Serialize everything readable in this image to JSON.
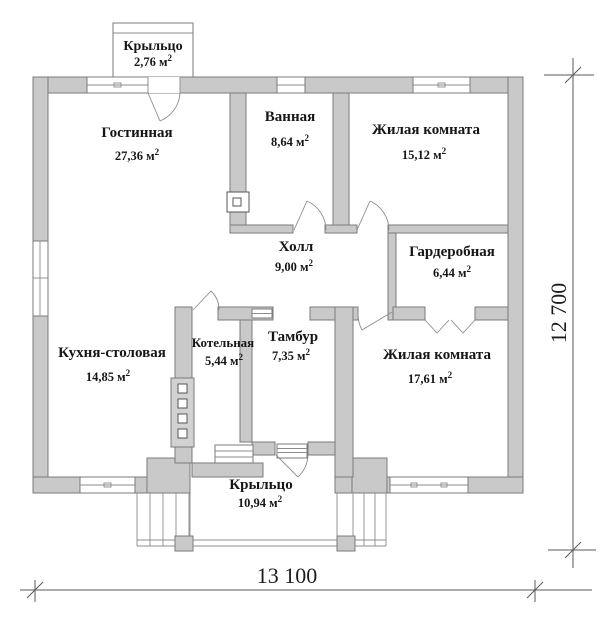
{
  "plan": {
    "type": "floor-plan",
    "rooms": [
      {
        "name": "Крыльцо",
        "area": "2,76 м",
        "sup": "2"
      },
      {
        "name": "Гостинная",
        "area": "27,36 м",
        "sup": "2"
      },
      {
        "name": "Ванная",
        "area": "8,64 м",
        "sup": "2"
      },
      {
        "name": "Жилая комната",
        "area": "15,12 м",
        "sup": "2"
      },
      {
        "name": "Холл",
        "area": "9,00 м",
        "sup": "2"
      },
      {
        "name": "Гардеробная",
        "area": "6,44 м",
        "sup": "2"
      },
      {
        "name": "Кухня-столовая",
        "area": "14,85 м",
        "sup": "2"
      },
      {
        "name": "Котельная",
        "area": "5,44 м",
        "sup": "2"
      },
      {
        "name": "Тамбур",
        "area": "7,35 м",
        "sup": "2"
      },
      {
        "name": "Жилая комната",
        "area": "17,61 м",
        "sup": "2"
      },
      {
        "name": "Крыльцо",
        "area": "10,94 м",
        "sup": "2"
      }
    ],
    "dimensions": {
      "width": "13 100",
      "height": "12 700"
    },
    "colors": {
      "wall_fill": "#c9c9c9",
      "wall_stroke": "#7b7b7b",
      "text": "#161616"
    }
  }
}
